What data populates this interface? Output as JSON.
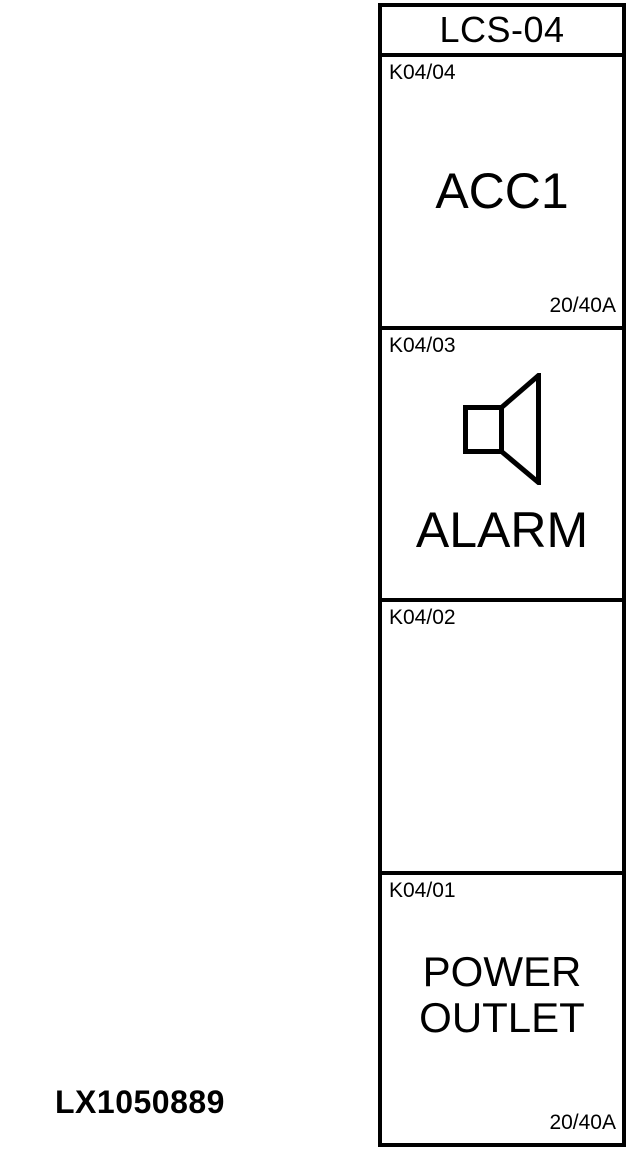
{
  "figure": {
    "id_label": "LX1050889"
  },
  "panel": {
    "title": "LCS-04",
    "cells": [
      {
        "id": "K04/04",
        "name": "ACC1",
        "rating": "20/40A"
      },
      {
        "id": "K04/03",
        "name": "ALARM",
        "icon": "speaker-icon",
        "rating": ""
      },
      {
        "id": "K04/02",
        "name": "",
        "rating": ""
      },
      {
        "id": "K04/01",
        "lines": [
          "POWER",
          "OUTLET"
        ],
        "rating": "20/40A"
      }
    ]
  },
  "colors": {
    "line": "#000000",
    "background": "#ffffff"
  }
}
